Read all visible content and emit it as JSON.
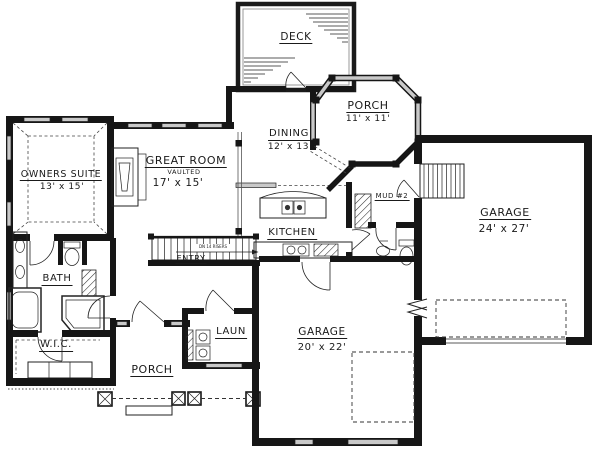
{
  "plan": {
    "deck": {
      "name": "DECK"
    },
    "side_porch": {
      "name": "PORCH",
      "dims": "11' x 11'"
    },
    "dining": {
      "name": "DINING",
      "dims": "12' x 13'"
    },
    "great_room": {
      "name": "GREAT ROOM",
      "note": "VAULTED",
      "dims": "17' x 15'"
    },
    "owners_suite": {
      "name": "OWNERS SUITE",
      "dims": "13' x 15'"
    },
    "kitchen": {
      "name": "KITCHEN"
    },
    "mud_room": {
      "name": "MUD #2"
    },
    "garage_side": {
      "name": "GARAGE",
      "dims": "24' x 27'"
    },
    "garage_front": {
      "name": "GARAGE",
      "dims": "20' x 22'"
    },
    "bath": {
      "name": "BATH"
    },
    "closet": {
      "name": "W.I.C."
    },
    "laundry": {
      "name": "LAUN"
    },
    "front_porch": {
      "name": "PORCH"
    },
    "entry": {
      "name": "ENTRY"
    },
    "stairs": {
      "note": "DN 14 RISERS"
    }
  },
  "colors": {
    "wall": "#161616",
    "window": "#c9c9c9",
    "paper": "#ffffff"
  }
}
